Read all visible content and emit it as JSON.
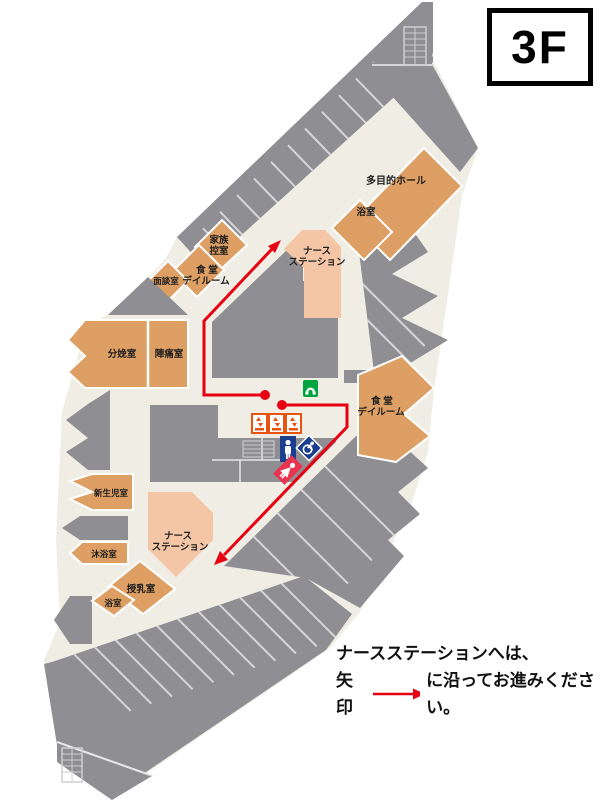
{
  "floor_badge": "3F",
  "map": {
    "rooms": {
      "multipurpose_hall": "多目的ホール",
      "bath_upper": "浴室",
      "family_room_l1": "家族",
      "family_room_l2": "控室",
      "meeting_room": "面談室",
      "dining_dayroom_left_l1": "食 堂",
      "dining_dayroom_left_l2": "デイルーム",
      "nurse_station_upper_l1": "ナース",
      "nurse_station_upper_l2": "ステーション",
      "delivery_room": "分娩室",
      "labor_room": "陣痛室",
      "dining_dayroom_right_l1": "食 堂",
      "dining_dayroom_right_l2": "デイルーム",
      "newborn_room": "新生児室",
      "nurse_station_lower_l1": "ナース",
      "nurse_station_lower_l2": "ステーション",
      "baby_bath_room": "沐浴室",
      "nursing_room": "授乳室",
      "bath_lower": "浴室"
    },
    "icons": {
      "phone": "public-phone",
      "elevators": [
        "elevator",
        "elevator",
        "elevator"
      ],
      "mens_toilet": "mens-toilet",
      "accessible_toilet": "accessible-toilet",
      "womens_toilet": "womens-toilet",
      "stairs_top": "stairs",
      "stairs_bottom": "stairs"
    },
    "route": {
      "destination": "ナースステーション",
      "color": "#e60012"
    }
  },
  "legend": {
    "line1": "ナースステーションへは、",
    "line2_before_arrow": "矢印",
    "line2_after_arrow": "に沿ってお進みください。"
  },
  "colors": {
    "room_gray": "#8e8e93",
    "room_orange": "#dd9f63",
    "nurse_station_pink": "#f4c6a6",
    "corridor_beige": "#f0eee4",
    "route_red": "#e60012",
    "phone_green": "#00a53f",
    "toilet_blue": "#1c3e8f",
    "toilet_red": "#e8344e",
    "elevator_orange": "#e85410",
    "divider_line": "#d6d6d8"
  }
}
